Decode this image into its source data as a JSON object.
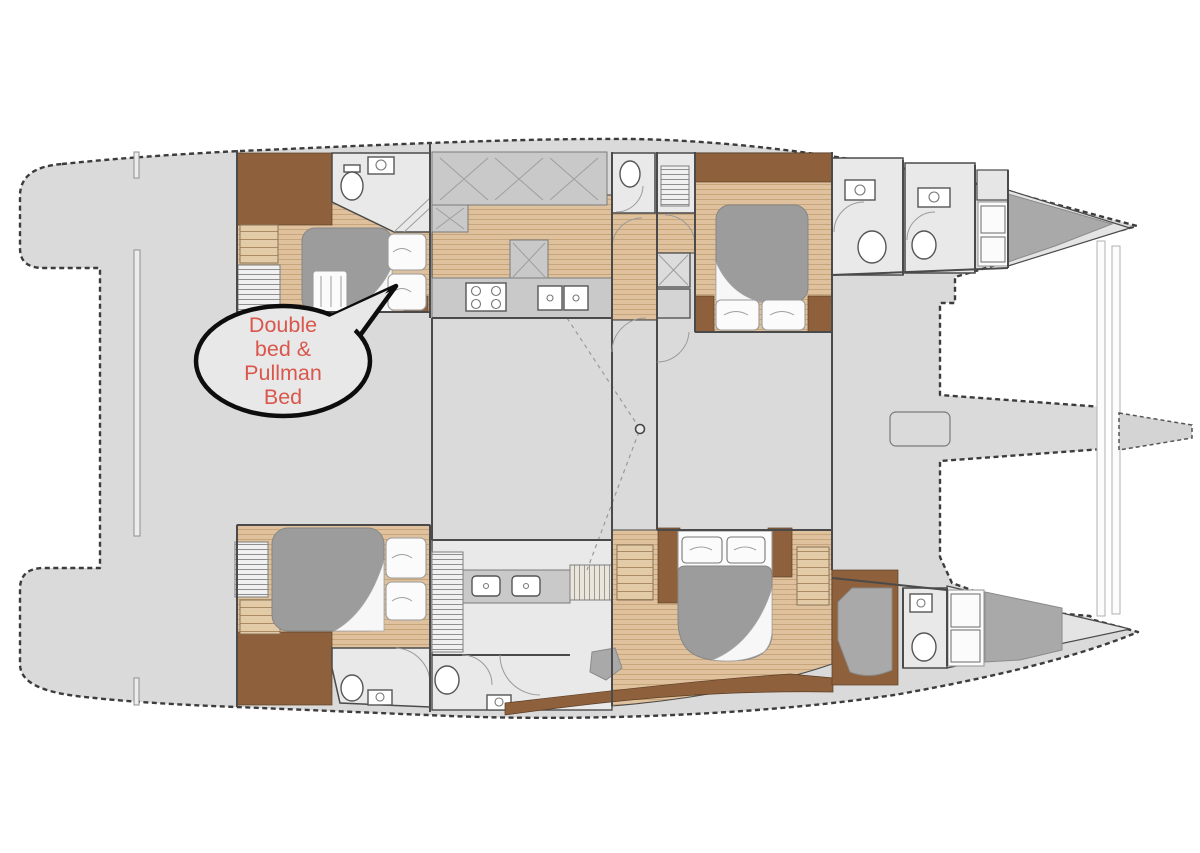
{
  "annotation": {
    "text": "Double bed & Pullman Bed",
    "lines": [
      "Double",
      "bed &",
      "Pullman",
      "Bed"
    ]
  },
  "colors": {
    "background": "#ffffff",
    "deck": "#dadada",
    "room": "#e9e9e9",
    "wood_floor": "#dfc19d",
    "wood_line": "#c4a277",
    "joinery_brown": "#8e613c",
    "counter_gray": "#c9c9c9",
    "bed_duvet": "#9c9c9c",
    "linen_white": "#fbfbfb",
    "outline": "#3c3c3c",
    "callout_fill": "#e8e8e8",
    "callout_border": "#0d0d0d",
    "callout_text": "#d9574c"
  }
}
